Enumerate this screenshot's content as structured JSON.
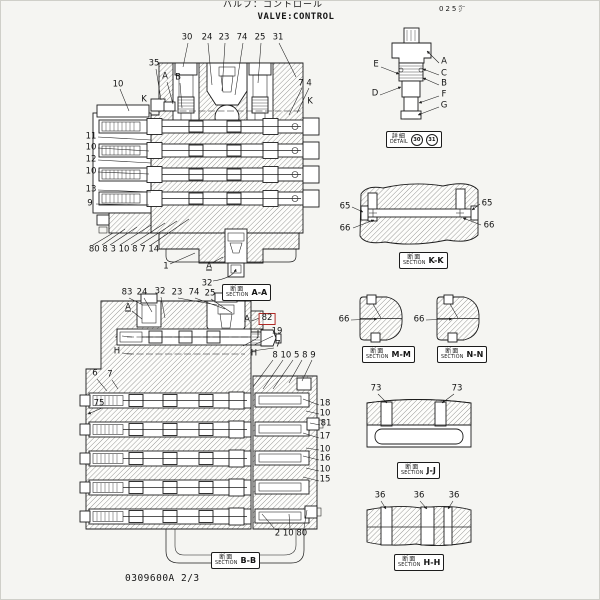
{
  "page": {
    "title_jp": "バルブ：コントロール",
    "title_en": "VALVE:CONTROL",
    "page_ref": "025㌻",
    "doc_number": "0309600A 2/3"
  },
  "colors": {
    "ink": "#1c1c1c",
    "paper": "#f5f5f2",
    "highlight_red": "#b02a25"
  },
  "labels": {
    "section_jp": "断面",
    "section_en": "SECTION",
    "detail_jp": "詳細",
    "detail_en": "DETAIL"
  },
  "detail_box": {
    "x": 385,
    "y": 130,
    "circled_parts": [
      "30",
      "31"
    ]
  },
  "section_boxes": [
    {
      "ref": "A-A",
      "x": 221,
      "y": 283
    },
    {
      "ref": "B-B",
      "x": 210,
      "y": 551
    },
    {
      "ref": "K-K",
      "x": 398,
      "y": 251
    },
    {
      "ref": "M-M",
      "x": 361,
      "y": 345
    },
    {
      "ref": "N-N",
      "x": 436,
      "y": 345
    },
    {
      "ref": "J-J",
      "x": 396,
      "y": 461
    },
    {
      "ref": "H-H",
      "x": 393,
      "y": 553
    }
  ],
  "callouts": [
    {
      "t": "30",
      "x": 186,
      "y": 37
    },
    {
      "t": "24",
      "x": 206,
      "y": 37
    },
    {
      "t": "23",
      "x": 223,
      "y": 37
    },
    {
      "t": "74",
      "x": 241,
      "y": 37
    },
    {
      "t": "25",
      "x": 259,
      "y": 37
    },
    {
      "t": "31",
      "x": 277,
      "y": 37
    },
    {
      "t": "35",
      "x": 153,
      "y": 63
    },
    {
      "t": "A",
      "x": 164,
      "y": 76
    },
    {
      "t": "B",
      "x": 177,
      "y": 77
    },
    {
      "t": "10",
      "x": 117,
      "y": 84
    },
    {
      "t": "K",
      "x": 143,
      "y": 99
    },
    {
      "t": "7 4",
      "x": 304,
      "y": 83
    },
    {
      "t": "K",
      "x": 309,
      "y": 101
    },
    {
      "t": "11",
      "x": 90,
      "y": 136
    },
    {
      "t": "10",
      "x": 90,
      "y": 147
    },
    {
      "t": "12",
      "x": 90,
      "y": 159
    },
    {
      "t": "10",
      "x": 90,
      "y": 171
    },
    {
      "t": "13",
      "x": 90,
      "y": 189
    },
    {
      "t": "9",
      "x": 89,
      "y": 203
    },
    {
      "t": "80 8 3 10 8 7 14",
      "x": 123,
      "y": 249
    },
    {
      "t": "1",
      "x": 165,
      "y": 266
    },
    {
      "t": "A",
      "x": 208,
      "y": 266,
      "u": true
    },
    {
      "t": "32",
      "x": 206,
      "y": 283
    },
    {
      "t": "83",
      "x": 126,
      "y": 292
    },
    {
      "t": "24",
      "x": 141,
      "y": 292
    },
    {
      "t": "32",
      "x": 159,
      "y": 291
    },
    {
      "t": "23",
      "x": 176,
      "y": 292
    },
    {
      "t": "74",
      "x": 193,
      "y": 292
    },
    {
      "t": "25",
      "x": 209,
      "y": 293
    },
    {
      "t": "A",
      "x": 127,
      "y": 307,
      "u": true
    },
    {
      "t": "J",
      "x": 116,
      "y": 333
    },
    {
      "t": "H",
      "x": 116,
      "y": 351
    },
    {
      "t": "6",
      "x": 94,
      "y": 373
    },
    {
      "t": "7",
      "x": 109,
      "y": 374
    },
    {
      "t": "75",
      "x": 98,
      "y": 403
    },
    {
      "t": "A",
      "x": 246,
      "y": 319
    },
    {
      "t": "82",
      "x": 266,
      "y": 318,
      "b": true
    },
    {
      "t": "J",
      "x": 257,
      "y": 334
    },
    {
      "t": "19",
      "x": 276,
      "y": 331
    },
    {
      "t": "7",
      "x": 277,
      "y": 344
    },
    {
      "t": "H",
      "x": 253,
      "y": 353
    },
    {
      "t": "8 10 5 8 9",
      "x": 293,
      "y": 355
    },
    {
      "t": "18",
      "x": 324,
      "y": 403
    },
    {
      "t": "10",
      "x": 324,
      "y": 413
    },
    {
      "t": "81",
      "x": 325,
      "y": 423
    },
    {
      "t": "17",
      "x": 324,
      "y": 436
    },
    {
      "t": "10",
      "x": 324,
      "y": 449
    },
    {
      "t": "16",
      "x": 324,
      "y": 458
    },
    {
      "t": "10",
      "x": 324,
      "y": 469
    },
    {
      "t": "15",
      "x": 324,
      "y": 479
    },
    {
      "t": "2 10 80",
      "x": 290,
      "y": 533
    },
    {
      "t": "E",
      "x": 375,
      "y": 64
    },
    {
      "t": "D",
      "x": 374,
      "y": 93
    },
    {
      "t": "A",
      "x": 443,
      "y": 61
    },
    {
      "t": "C",
      "x": 443,
      "y": 73
    },
    {
      "t": "B",
      "x": 443,
      "y": 83
    },
    {
      "t": "F",
      "x": 443,
      "y": 94
    },
    {
      "t": "G",
      "x": 443,
      "y": 105
    },
    {
      "t": "65",
      "x": 344,
      "y": 206
    },
    {
      "t": "65",
      "x": 486,
      "y": 203
    },
    {
      "t": "66",
      "x": 344,
      "y": 228
    },
    {
      "t": "66",
      "x": 488,
      "y": 225
    },
    {
      "t": "66",
      "x": 343,
      "y": 319
    },
    {
      "t": "66",
      "x": 418,
      "y": 319
    },
    {
      "t": "73",
      "x": 375,
      "y": 388
    },
    {
      "t": "73",
      "x": 456,
      "y": 388
    },
    {
      "t": "36",
      "x": 379,
      "y": 495
    },
    {
      "t": "36",
      "x": 418,
      "y": 495
    },
    {
      "t": "36",
      "x": 453,
      "y": 495
    }
  ]
}
